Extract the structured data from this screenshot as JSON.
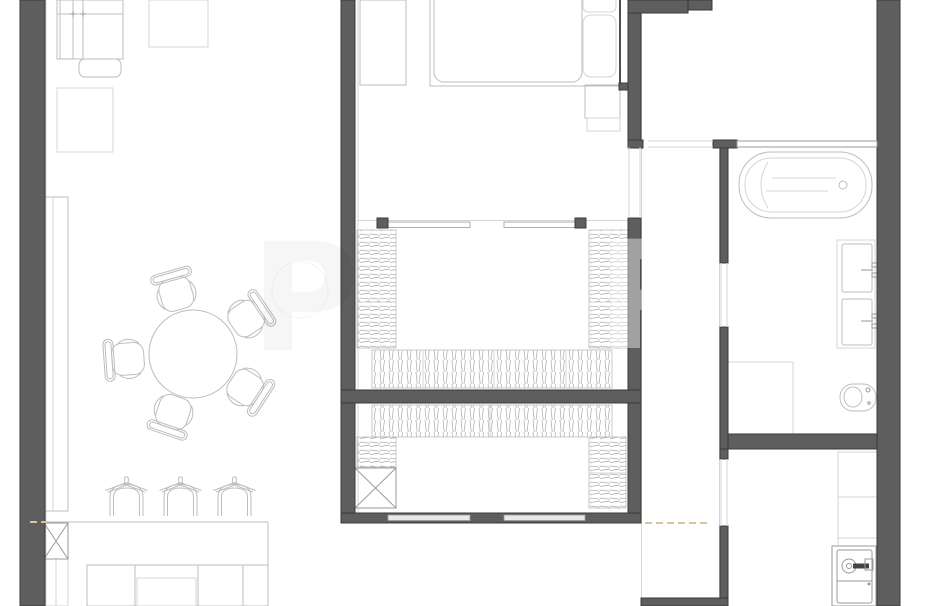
{
  "meta": {
    "type": "architectural-floor-plan",
    "view": "top-down",
    "width_px": 926,
    "height_px": 606
  },
  "colors": {
    "bg": "#ffffff",
    "wall": "#5e5e5e",
    "walledge": "#3b3b3b",
    "line": "#bdbdbd",
    "linelight": "#d6d6d6",
    "linemed": "#9a9a9a",
    "dark": "#161616",
    "hatch": "#a8a8a8",
    "dashed": "#d9c59c"
  },
  "rooms": [
    {
      "id": "living-dining-kitchen",
      "position": "left",
      "furniture": [
        "corner-sofa",
        "ottoman",
        "side-table",
        "armchair-square",
        "media-console",
        "round-dining-table",
        "dining-chair-1",
        "dining-chair-2",
        "dining-chair-3",
        "dining-chair-4",
        "dining-chair-5",
        "bar-stool-1",
        "bar-stool-2",
        "bar-stool-3",
        "kitchen-counter",
        "kitchen-island",
        "structural-column"
      ]
    },
    {
      "id": "bedroom",
      "position": "top-center",
      "furniture": [
        "wardrobe",
        "double-bed",
        "pillows",
        "nightstand",
        "sliding-door-track"
      ]
    },
    {
      "id": "walk-in-closet-upper",
      "position": "center",
      "furniture": [
        "wardrobe-left",
        "wardrobe-right",
        "wardrobe-bottom-row"
      ]
    },
    {
      "id": "walk-in-closet-lower",
      "position": "center-bottom",
      "furniture": [
        "wardrobe-top-row",
        "wardrobe-left-small",
        "structural-column",
        "wardrobe-right"
      ]
    },
    {
      "id": "top-right-room",
      "position": "top-right",
      "furniture": []
    },
    {
      "id": "bathroom",
      "position": "right",
      "furniture": [
        "bathtub",
        "shower-tray",
        "double-sink-vanity",
        "toilet",
        "glass-partition"
      ]
    },
    {
      "id": "entry-hall",
      "position": "bottom-right",
      "furniture": [
        "shelving-unit",
        "washing-machine"
      ]
    }
  ],
  "annotations": {
    "section-cut-dashes": 2,
    "door-openings": 4,
    "watermark_present": true
  }
}
